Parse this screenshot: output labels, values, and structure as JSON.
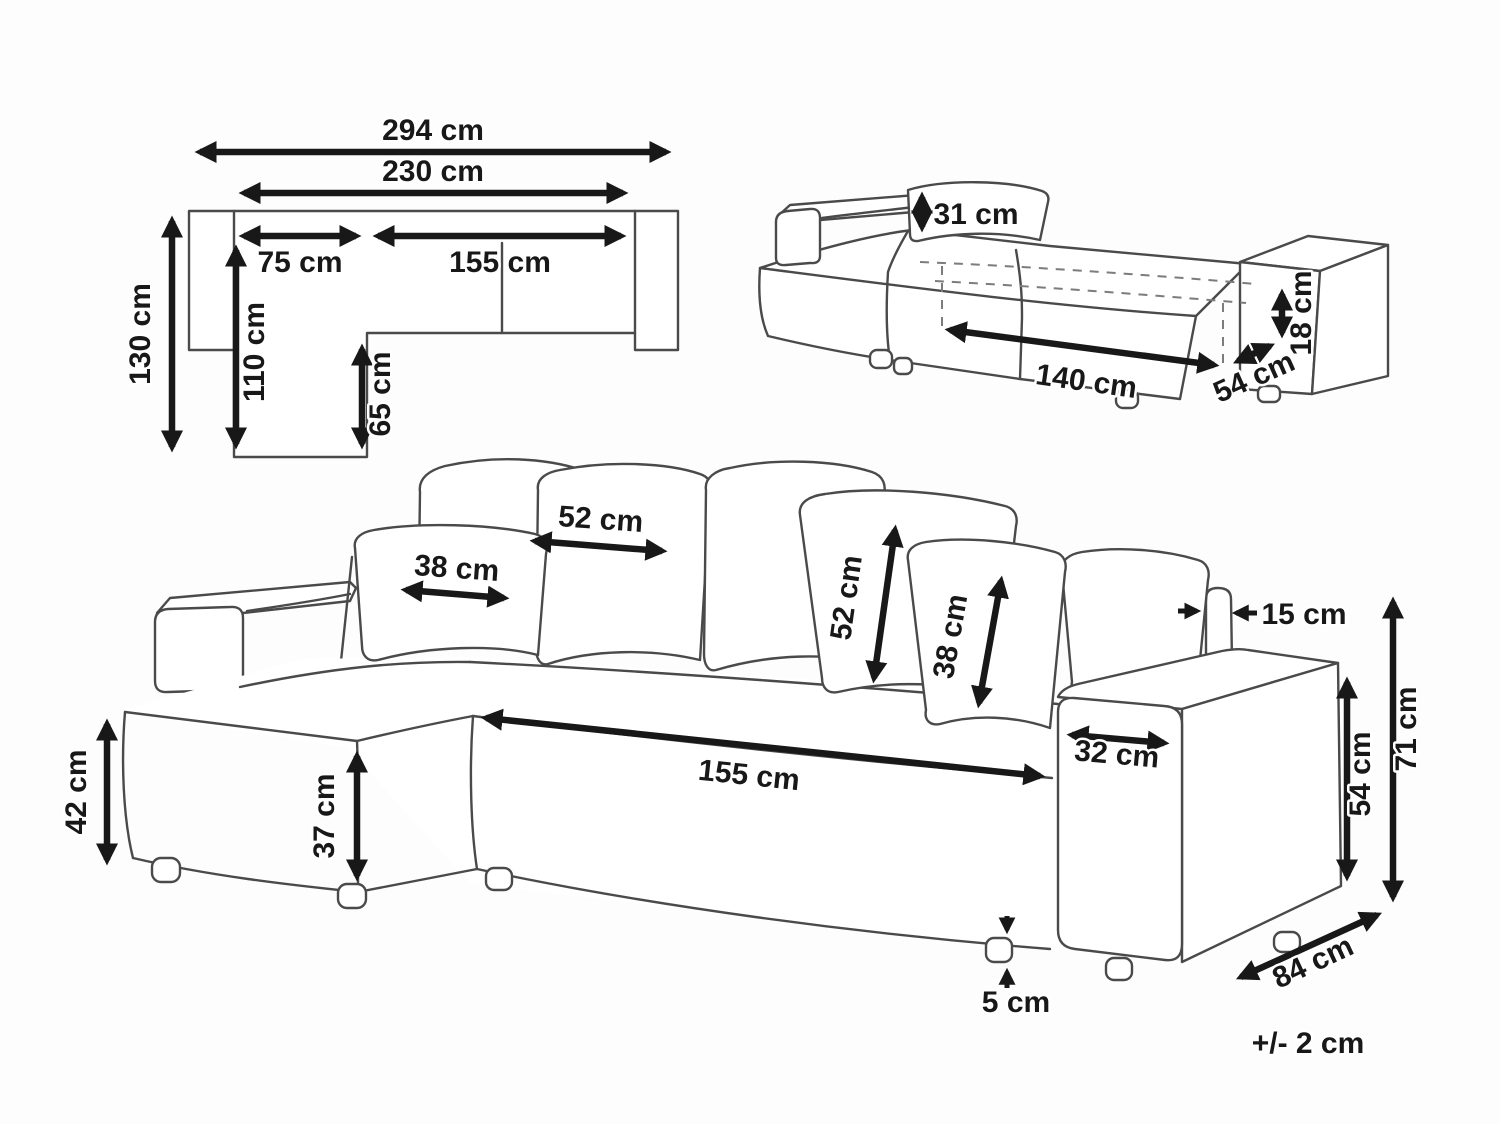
{
  "diagram": {
    "tolerance_note": "+/- 2 cm",
    "plan": {
      "total_width": "294 cm",
      "inner_width": "230 cm",
      "chaise_width": "75 cm",
      "seat_width": "155 cm",
      "total_depth": "130 cm",
      "chaise_depth": "110 cm",
      "seat_depth": "65 cm"
    },
    "bed": {
      "backrest_height": "31 cm",
      "sleep_length": "140 cm",
      "extension_depth": "54 cm",
      "frame_height": "18 cm"
    },
    "sofa": {
      "cushion_large_width": "52 cm",
      "cushion_small_width": "38 cm",
      "cushion_large_height": "52 cm",
      "cushion_small_height": "38 cm",
      "backrest_thickness": "15 cm",
      "chaise_seat_height": "42 cm",
      "chaise_front_height": "37 cm",
      "seat_length": "155 cm",
      "armrest_width": "32 cm",
      "armrest_height": "54 cm",
      "overall_height": "71 cm",
      "depth": "84 cm",
      "leg_height": "5 cm"
    }
  }
}
